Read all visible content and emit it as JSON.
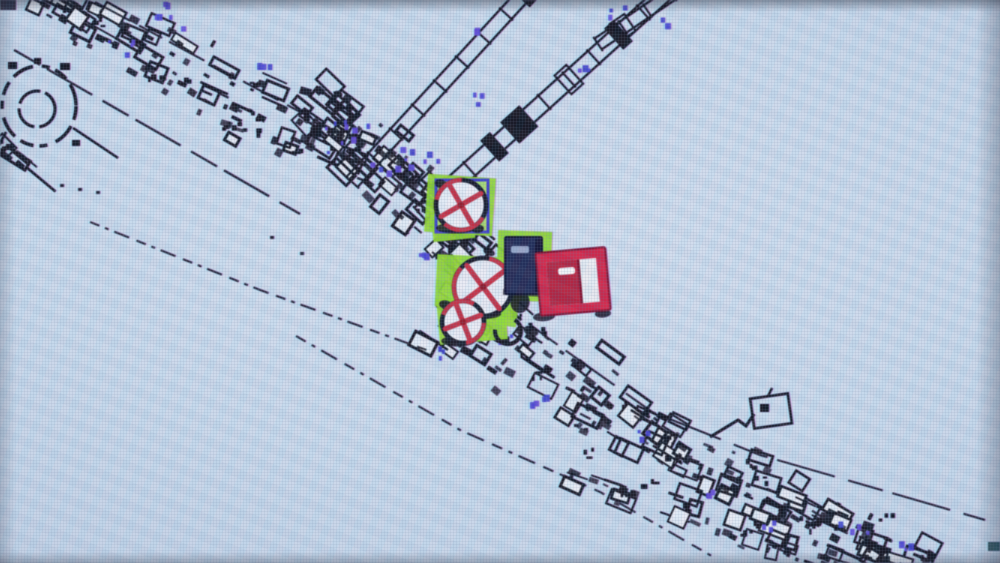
{
  "palette": {
    "screen_bg": "#c9dbec",
    "ink": "#10141f",
    "paper": "#e4ecf5",
    "grid_line": "#6e82a0",
    "accent_blue": "#4343d2",
    "accent_blue_alt": "#5b49d8",
    "accent_blue_dark": "#3b3fc8",
    "highlight_green": "#8fdc2e",
    "valve_red": "#c02e42",
    "valve_hub_red": "#8e1626",
    "door_tile_red": "#ce2346",
    "door_leaf_red": "#b2203c",
    "door_frame_dark": "#7d0e2c",
    "doorway_white": "#e9eef3",
    "door_navy": "#1f2852",
    "door_navy_dark": "#0c1130",
    "door_slot_blue": "#96a6c8",
    "slot_white": "#f4f6f8",
    "teal_mark": "#1d4a50"
  },
  "icon_glyphs": {
    "closed-valve-icon": "⊗",
    "door-icon": "▯"
  },
  "scene": {
    "viewport": {
      "width": 1000,
      "height": 563
    },
    "bands": [
      {
        "id": "top-left-band",
        "pts": [
          [
            40,
            -8
          ],
          [
            200,
            82
          ],
          [
            370,
            158
          ]
        ],
        "hw": [
          40,
          46,
          44
        ],
        "clusters": 130,
        "seed": 11
      },
      {
        "id": "junction-cluster",
        "pts": [
          [
            305,
            98
          ],
          [
            470,
            238
          ]
        ],
        "hw": [
          48,
          54
        ],
        "clusters": 125,
        "seed": 7
      },
      {
        "id": "mid-bridge",
        "pts": [
          [
            438,
            228
          ],
          [
            520,
            302
          ]
        ],
        "hw": [
          36,
          40
        ],
        "clusters": 48,
        "seed": 15
      },
      {
        "id": "main-band",
        "pts": [
          [
            438,
            298
          ],
          [
            560,
            380
          ],
          [
            680,
            455
          ],
          [
            820,
            520
          ],
          [
            925,
            566
          ]
        ],
        "hw": [
          58,
          62,
          55,
          45,
          38
        ],
        "clusters": 250,
        "seed": 23
      },
      {
        "id": "lower-row",
        "pts": [
          [
            560,
            470
          ],
          [
            900,
            585
          ]
        ],
        "hw": [
          20,
          22
        ],
        "clusters": 60,
        "seed": 31
      },
      {
        "id": "left-edge-blobs",
        "pts": [
          [
            -6,
            138
          ],
          [
            30,
            168
          ]
        ],
        "hw": [
          15,
          15
        ],
        "clusters": 10,
        "seed": 5
      }
    ],
    "streets": [
      {
        "pts": [
          [
            14,
            50
          ],
          [
            300,
            214
          ]
        ],
        "dash": "30 8 52 12",
        "w": 2.2
      },
      {
        "pts": [
          [
            95,
            2
          ],
          [
            330,
            128
          ]
        ],
        "dash": "40 10 26 8",
        "w": 2
      },
      {
        "pts": [
          [
            432,
            252
          ],
          [
            548,
            338
          ],
          [
            652,
            412
          ],
          [
            760,
            455
          ],
          [
            985,
            520
          ]
        ],
        "dash": "36 10 60 14",
        "w": 2
      }
    ],
    "dashed_edges": [
      {
        "pts": [
          [
            90,
            222
          ],
          [
            260,
            290
          ],
          [
            432,
            352
          ]
        ],
        "dash": "10 6 4 6 16 8",
        "w": 2
      },
      {
        "pts": [
          [
            296,
            336
          ],
          [
            460,
            430
          ],
          [
            600,
            492
          ],
          [
            715,
            558
          ]
        ],
        "dash": "11 7 4 7 18 9",
        "w": 2
      }
    ],
    "rails": [
      {
        "x1": 352,
        "y1": 182,
        "x2": 528,
        "y2": -10,
        "gap": 15,
        "tie": 30,
        "seed": 41
      },
      {
        "x1": 420,
        "y1": 214,
        "x2": 668,
        "y2": -10,
        "gap": 17,
        "tie": 32,
        "seed": 43
      },
      {
        "x1": 598,
        "y1": 44,
        "x2": 672,
        "y2": -6,
        "gap": 13,
        "tie": 26,
        "seed": 47
      }
    ],
    "circle_structure": {
      "cx": 39,
      "cy": 106,
      "rx": 37,
      "ry": 40,
      "inner_cx": 37,
      "inner_cy": 109,
      "inner_r": 18,
      "connector": [
        73,
        128,
        118,
        158
      ],
      "tail": [
        6,
        132,
        -8,
        158
      ],
      "rim_marks": [
        [
          8,
          62,
          9,
          7
        ],
        [
          60,
          63,
          10,
          7
        ],
        [
          72,
          140,
          8,
          6
        ],
        [
          6,
          144,
          8,
          6
        ],
        [
          34,
          58,
          7,
          6
        ]
      ]
    },
    "flag_structure": {
      "pole": [
        [
          710,
          437
        ],
        [
          738,
          420
        ],
        [
          746,
          426
        ],
        [
          754,
          414
        ]
      ],
      "box": [
        752,
        396,
        38,
        30
      ],
      "box_rot": -8,
      "inner": [
        760,
        404,
        9,
        8
      ],
      "stub": [
        [
          768,
          396
        ],
        [
          772,
          388
        ]
      ]
    },
    "corner_blob": [
      0,
      0,
      16,
      10
    ],
    "blue_dot_clusters": [
      [
        178,
        14,
        6,
        24
      ],
      [
        122,
        42,
        4,
        16
      ],
      [
        256,
        58,
        3,
        14
      ],
      [
        345,
        136,
        9,
        24
      ],
      [
        390,
        158,
        8,
        20
      ],
      [
        428,
        152,
        3,
        12
      ],
      [
        470,
        98,
        3,
        10
      ],
      [
        586,
        62,
        3,
        12
      ],
      [
        612,
        10,
        3,
        14
      ],
      [
        660,
        22,
        2,
        8
      ],
      [
        434,
        352,
        3,
        9
      ],
      [
        536,
        402,
        4,
        13
      ],
      [
        642,
        430,
        3,
        11
      ],
      [
        706,
        490,
        3,
        10
      ],
      [
        762,
        520,
        3,
        11
      ],
      [
        852,
        522,
        4,
        15
      ],
      [
        900,
        546,
        3,
        11
      ],
      [
        415,
        248,
        3,
        9
      ],
      [
        506,
        338,
        3,
        9
      ],
      [
        471,
        30,
        2,
        8
      ]
    ],
    "speckles": [
      [
        574,
        424
      ],
      [
        584,
        428
      ],
      [
        60,
        184
      ],
      [
        78,
        188
      ],
      [
        96,
        191
      ],
      [
        300,
        252
      ],
      [
        270,
        236
      ],
      [
        988,
        542,
        12,
        9,
        "#1d4a50"
      ],
      [
        880,
        556,
        10,
        7
      ]
    ]
  },
  "overlays": {
    "highlight_patches": [
      {
        "rects": [
          [
            426,
            176,
            68,
            58,
            4
          ],
          [
            432,
            212,
            42,
            28,
            -6
          ]
        ]
      },
      {
        "rects": [
          [
            436,
            256,
            74,
            52,
            3
          ],
          [
            438,
            296,
            68,
            46,
            -5
          ],
          [
            498,
            294,
            20,
            32,
            8
          ]
        ]
      },
      {
        "rects": [
          [
            497,
            231,
            54,
            70,
            2
          ]
        ]
      }
    ],
    "selection_frame": {
      "x": 436,
      "y": 180,
      "w": 52,
      "h": 52,
      "stroke_w": 3
    },
    "valves": [
      {
        "name": "valve-top",
        "cx": 461,
        "cy": 205,
        "r": 25,
        "cross_rot": 15,
        "arc_rot": 30
      },
      {
        "name": "valve-middle",
        "cx": 483,
        "cy": 287,
        "r": 29,
        "cross_rot": 8,
        "arc_rot": 120
      },
      {
        "name": "valve-bottom",
        "cx": 463,
        "cy": 322,
        "r": 21,
        "cross_rot": 24,
        "arc_rot": 200
      }
    ],
    "partial_ring": {
      "cx": 508,
      "cy": 331,
      "r": 13
    },
    "ink_blobs": [
      [
        441,
        184,
        9,
        7,
        20
      ],
      [
        478,
        229,
        8,
        6,
        -10
      ],
      [
        446,
        305,
        10,
        7,
        15
      ],
      [
        489,
        252,
        8,
        5,
        25
      ],
      [
        520,
        302,
        15,
        20,
        8
      ],
      [
        531,
        331,
        11,
        8,
        20
      ],
      [
        452,
        341,
        9,
        6,
        0
      ]
    ],
    "blue_door": {
      "x": 505,
      "y": 237,
      "w": 37,
      "h": 57,
      "slot": [
        511,
        246,
        18,
        7
      ]
    },
    "red_door": {
      "x": 538,
      "y": 250,
      "w": 70,
      "h": 63,
      "rot": -5,
      "doorway": [
        548,
        260,
        50,
        44
      ],
      "leaf": [
        548,
        260,
        32,
        44
      ],
      "slot": [
        559,
        267,
        17,
        7
      ],
      "shadows": [
        [
          541,
          314,
          11,
          4.5
        ],
        [
          600,
          316,
          8,
          4
        ]
      ]
    }
  }
}
